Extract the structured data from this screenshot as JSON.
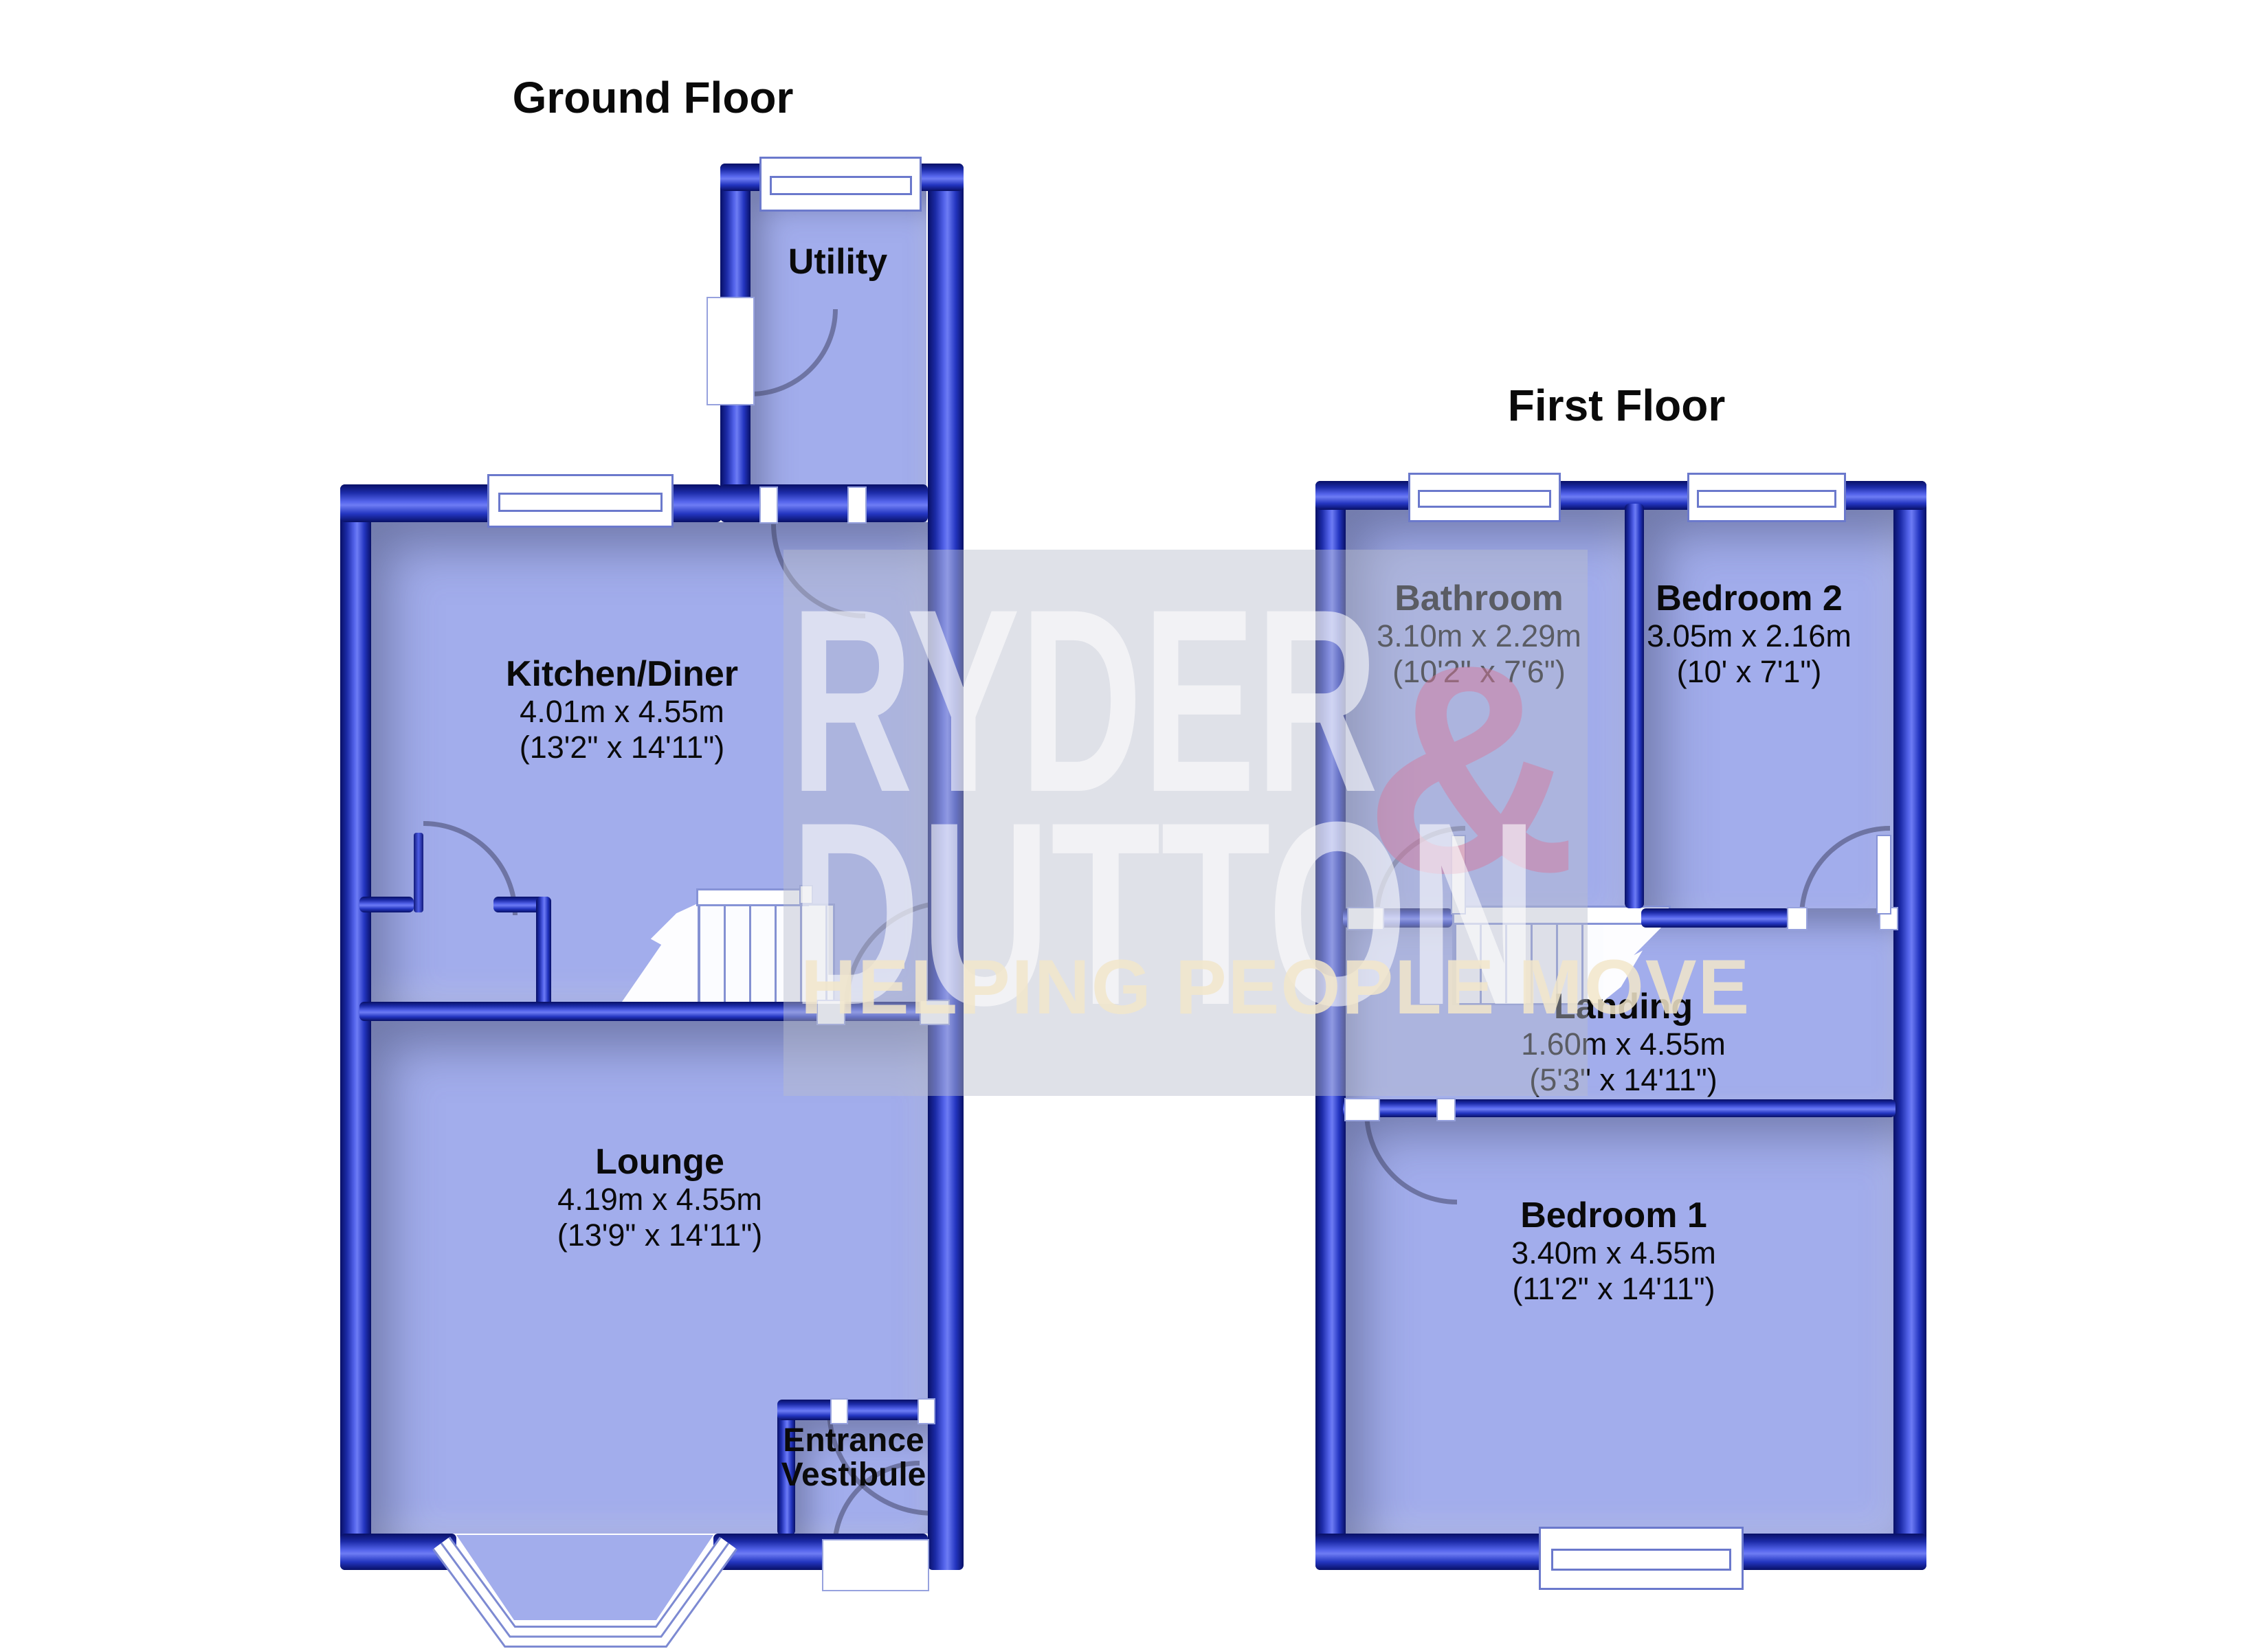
{
  "document_type": "floorplan",
  "colors": {
    "wall_blue": "#2335c0",
    "room_fill": "#a2adec",
    "watermark_band": "#b9becd",
    "watermark_text": "#ffffff",
    "watermark_amp_pink": "#d5789b",
    "tagline_cream": "#f2e6ca",
    "label_text": "#0a0a0a"
  },
  "watermark": {
    "brand_top": "RYDER",
    "brand_amp": "&",
    "brand_bottom": "DUTTON",
    "tagline": "HELPING PEOPLE MOVE"
  },
  "ground_floor": {
    "title": "Ground Floor",
    "rooms": {
      "utility": {
        "name": "Utility"
      },
      "kitchen": {
        "name": "Kitchen/Diner",
        "size_m": "4.01m x 4.55m",
        "size_ft": "(13'2\" x 14'11\")"
      },
      "lounge": {
        "name": "Lounge",
        "size_m": "4.19m x 4.55m",
        "size_ft": "(13'9\" x 14'11\")"
      },
      "vestibule": {
        "name": "Entrance Vestibule"
      }
    }
  },
  "first_floor": {
    "title": "First Floor",
    "rooms": {
      "bathroom": {
        "name": "Bathroom",
        "size_m": "3.10m x 2.29m",
        "size_ft": "(10'2\" x 7'6\")"
      },
      "bedroom2": {
        "name": "Bedroom 2",
        "size_m": "3.05m x 2.16m",
        "size_ft": "(10' x 7'1\")"
      },
      "landing": {
        "name": "Landing",
        "size_m": "1.60m x 4.55m",
        "size_ft": "(5'3\" x 14'11\")"
      },
      "bedroom1": {
        "name": "Bedroom 1",
        "size_m": "3.40m x 4.55m",
        "size_ft": "(11'2\" x 14'11\")"
      }
    }
  }
}
